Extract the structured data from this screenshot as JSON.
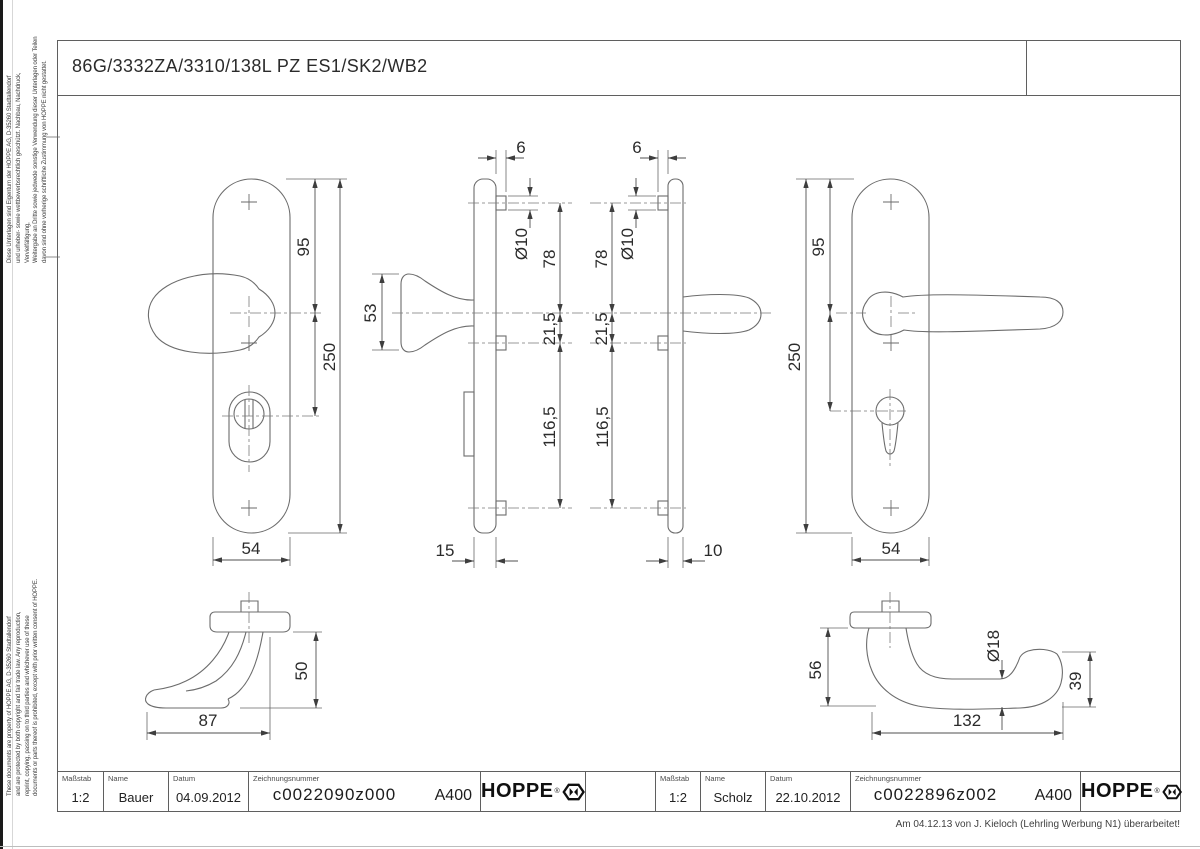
{
  "page": {
    "title": "86G/3332ZA/3310/138L PZ ES1/SK2/WB2",
    "revision_note": "Am 04.12.13 von J. Kieloch (Lehrling Werbung N1) überarbeitet!"
  },
  "side_notes": {
    "german": "Diese Unterlagen sind Eigentum der HOPPE AG, D-35260 Stadtallendorf\nund urheber- sowie wettbewerbsrechtlich geschützt. Nachbau, Nachdruck, Vervielfältigung,\nWeitergabe an Dritte sowie jedwede sonstige Verwendung dieser Unterlagen oder Teilen\ndavon sind ohne vorherige schriftliche Zustimmung von HOPPE nicht gestattet.",
    "english": "These documents are property of HOPPE AG, D-35260 Stadtallendorf\nand are protected by both copyright and fair trade law. Any reproduction,\nreprint, copying, passing on to third parties and whichever use of these\ndocuments or parts thereof is prohibited, except with prior written consent of HOPPE."
  },
  "dimensions": {
    "knob_front": {
      "top_to_handle": "95",
      "total_height": "250",
      "plate_width": "54"
    },
    "knob_side": {
      "lug_protrusion": "6",
      "lug_diameter": "Ø10",
      "knob_depth": "53",
      "handle_to_top_lug": "78",
      "handle_to_mid_lug": "21,5",
      "mid_to_bottom_lug": "116,5",
      "plate_depth": "15"
    },
    "lever_side": {
      "lug_protrusion": "6",
      "lug_diameter": "Ø10",
      "handle_to_top_lug": "78",
      "handle_to_mid_lug": "21,5",
      "mid_to_bottom_lug": "116,5",
      "plate_depth": "10"
    },
    "lever_front": {
      "top_to_handle": "95",
      "total_height": "250",
      "plate_width": "54"
    },
    "knob_profile": {
      "height": "50",
      "length": "87"
    },
    "lever_profile": {
      "height": "56",
      "grip_diameter": "Ø18",
      "end_height": "39",
      "length": "132"
    }
  },
  "title_blocks": {
    "labels": {
      "scale": "Maßstab",
      "name": "Name",
      "date": "Datum",
      "drawing_number": "Zeichnungsnummer"
    },
    "left": {
      "scale": "1:2",
      "name": "Bauer",
      "date": "04.09.2012",
      "drawing_number": "c0022090z000",
      "format": "A400",
      "brand": "HOPPE",
      "brand_reg": "®"
    },
    "right": {
      "scale": "1:2",
      "name": "Scholz",
      "date": "22.10.2012",
      "drawing_number": "c0022896z002",
      "format": "A400",
      "brand": "HOPPE",
      "brand_reg": "®"
    }
  }
}
